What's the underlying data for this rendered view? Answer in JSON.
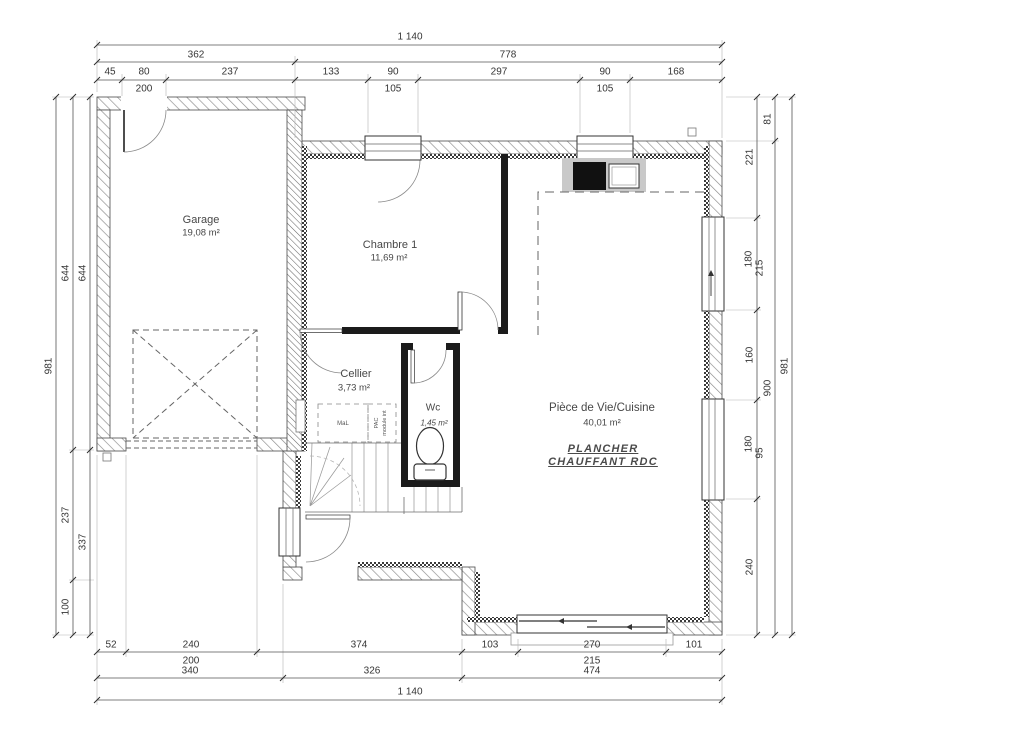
{
  "plan": {
    "rooms": {
      "garage": {
        "name": "Garage",
        "area": "19,08 m²"
      },
      "chambre1": {
        "name": "Chambre 1",
        "area": "11,69 m²"
      },
      "cellier": {
        "name": "Cellier",
        "area": "3,73 m²"
      },
      "wc": {
        "name": "Wc",
        "area": "1,45 m²"
      },
      "piece_de_vie": {
        "name": "Pièce de Vie/Cuisine",
        "area": "40,01 m²"
      }
    },
    "annotations": {
      "heating_line1": "PLANCHER",
      "heating_line2": "CHAUFFANT  RDC",
      "washing_machine": "MaL",
      "pac_line1": "PAC",
      "pac_line2": "module int"
    }
  },
  "dimensions": {
    "top": {
      "total": "1 140",
      "row2": [
        "362",
        "778"
      ],
      "row3": [
        "45",
        "80",
        "237",
        "133",
        "90",
        "297",
        "90",
        "168"
      ],
      "row3_sub": [
        "200",
        "105",
        "105"
      ]
    },
    "bottom": {
      "row1": [
        "52",
        "240",
        "374",
        "103",
        "270",
        "101"
      ],
      "row1_sub": [
        "200",
        "215"
      ],
      "row2": [
        "340",
        "326",
        "474"
      ],
      "total": "1 140"
    },
    "left": {
      "outer": "981",
      "middle": [
        "644",
        "237",
        "100"
      ],
      "inner": [
        "644",
        "337"
      ]
    },
    "right": {
      "inner": [
        "221",
        "180",
        "215",
        "160",
        "180",
        "95",
        "240"
      ],
      "middle": [
        "81",
        "900"
      ],
      "outer": "981"
    }
  }
}
